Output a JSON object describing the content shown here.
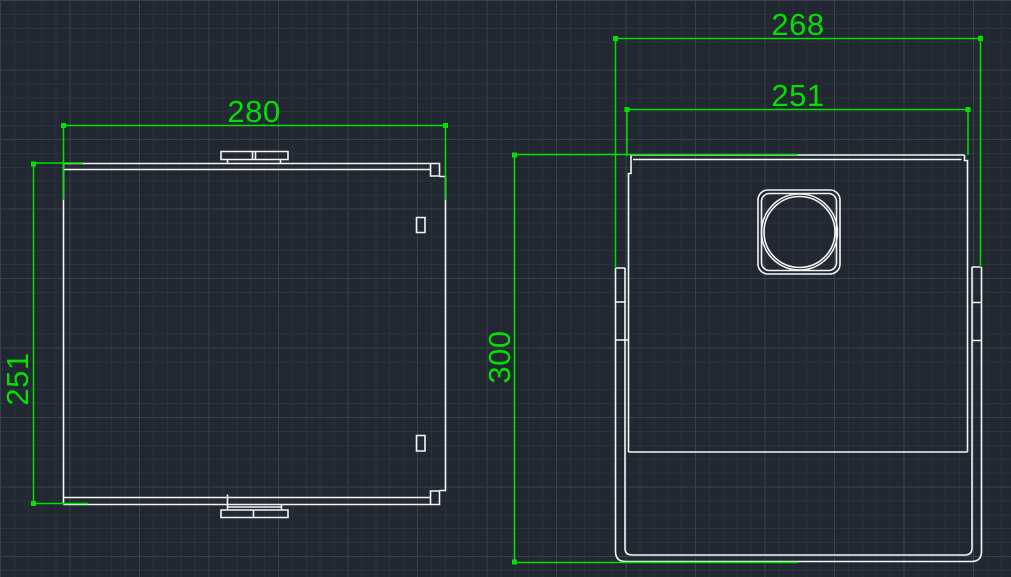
{
  "canvas": {
    "background_color": "#222831",
    "grid_minor_color": "#2b313c",
    "grid_major_color": "#39404e",
    "geometry_color": "#f5f5f5",
    "dimension_color": "#00e000"
  },
  "front_view": {
    "width_dimension": "280",
    "height_dimension": "251"
  },
  "side_view": {
    "outer_width_dimension": "268",
    "panel_width_dimension": "251",
    "height_dimension": "300"
  }
}
